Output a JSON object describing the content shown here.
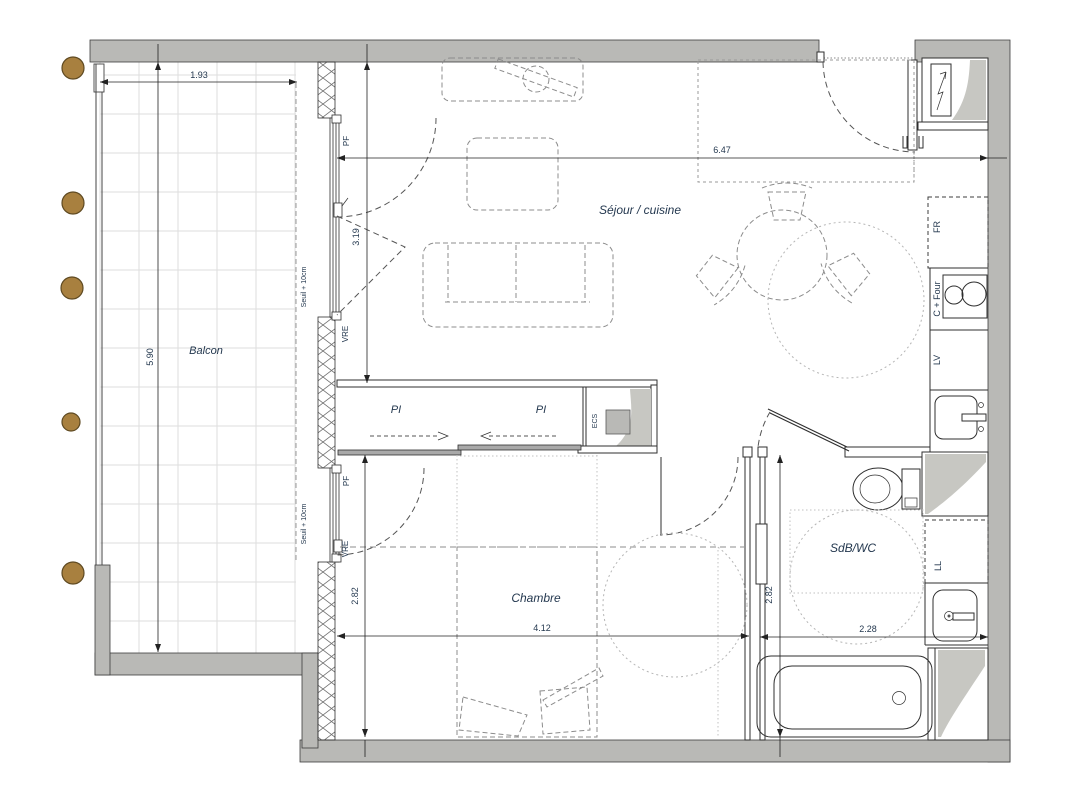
{
  "plan": {
    "rooms": {
      "balcony": {
        "label": "Balcon"
      },
      "living_kitchen": {
        "label": "Séjour / cuisine"
      },
      "bedroom": {
        "label": "Chambre"
      },
      "bathroom": {
        "label": "SdB/WC"
      },
      "closet": {
        "label_left": "PI",
        "label_right": "PI"
      }
    },
    "dimensions": {
      "balcony_width": "1.93",
      "balcony_length": "5.90",
      "living_width": "6.47",
      "living_depth": "3.19",
      "bedroom_depth": "2.82",
      "bedroom_width": "4.12",
      "bathroom_depth": "2.82",
      "bathroom_width": "2.28"
    },
    "window_labels": {
      "living_pf": "PF",
      "living_vre": "VRE",
      "living_threshold": "Seuil + 10cm",
      "bedroom_pf": "PF",
      "bedroom_vre": "VRE",
      "bedroom_threshold": "Seuil + 10cm"
    },
    "equipment": {
      "water_heater": "ECS",
      "fridge": "FR",
      "hob_oven": "C + Four",
      "dishwasher": "LV",
      "washing_machine": "LL"
    }
  }
}
